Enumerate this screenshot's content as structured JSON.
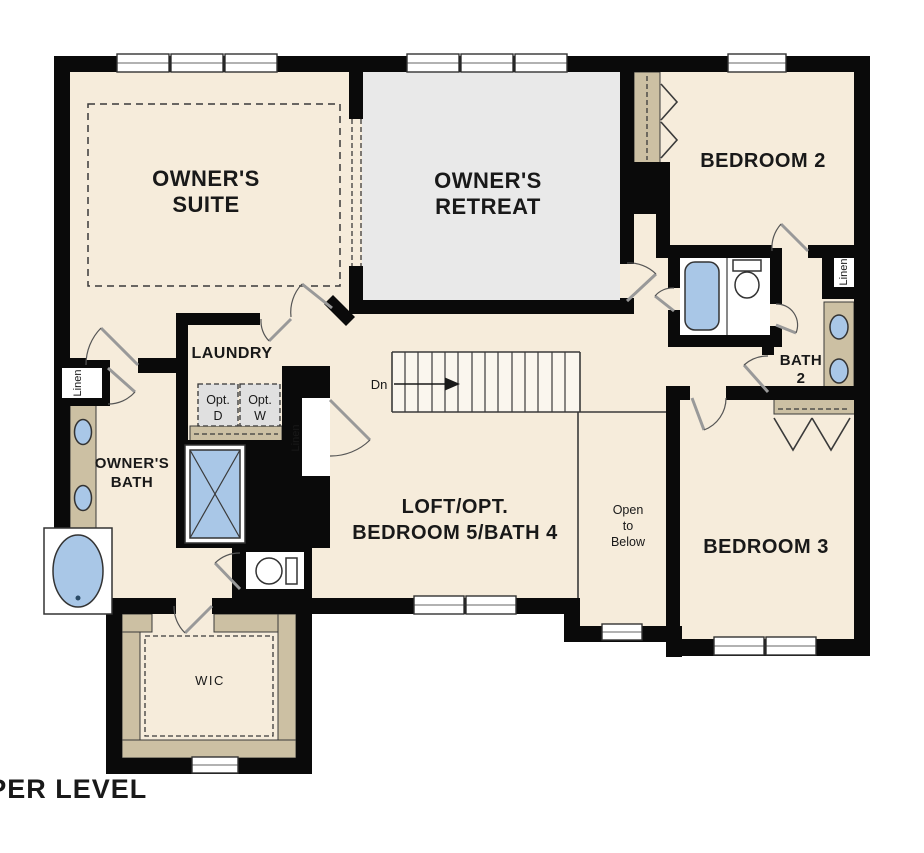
{
  "plan_title": "UPPER LEVEL",
  "rooms": {
    "owners_suite": {
      "line1": "OWNER'S",
      "line2": "SUITE"
    },
    "owners_retreat": {
      "line1": "OWNER'S",
      "line2": "RETREAT"
    },
    "bedroom_2": {
      "label": "BEDROOM 2"
    },
    "bedroom_3": {
      "label": "BEDROOM 3"
    },
    "bath_2": {
      "line1": "BATH",
      "line2": "2"
    },
    "owners_bath": {
      "line1": "OWNER'S",
      "line2": "BATH"
    },
    "laundry": {
      "label": "LAUNDRY"
    },
    "loft": {
      "line1": "LOFT/OPT.",
      "line2": "BEDROOM 5/BATH 4"
    },
    "wic": {
      "label": "WIC"
    },
    "open_to_below": {
      "line1": "Open",
      "line2": "to",
      "line3": "Below"
    }
  },
  "labels": {
    "stairs_down": "Dn",
    "linen": "Linen",
    "opt_dryer_line1": "Opt.",
    "opt_dryer_line2": "D",
    "opt_washer_line1": "Opt.",
    "opt_washer_line2": "W"
  },
  "colors": {
    "wall": "#0a0a0a",
    "floor": "#f6ecdb",
    "retreat_floor": "#e9e9e9",
    "casework_tan": "#ccc0a3",
    "fixture_blue": "#a9c7e7",
    "appliance_gray": "#e0e0e0",
    "fixture_white": "#ffffff",
    "text": "#191919"
  }
}
